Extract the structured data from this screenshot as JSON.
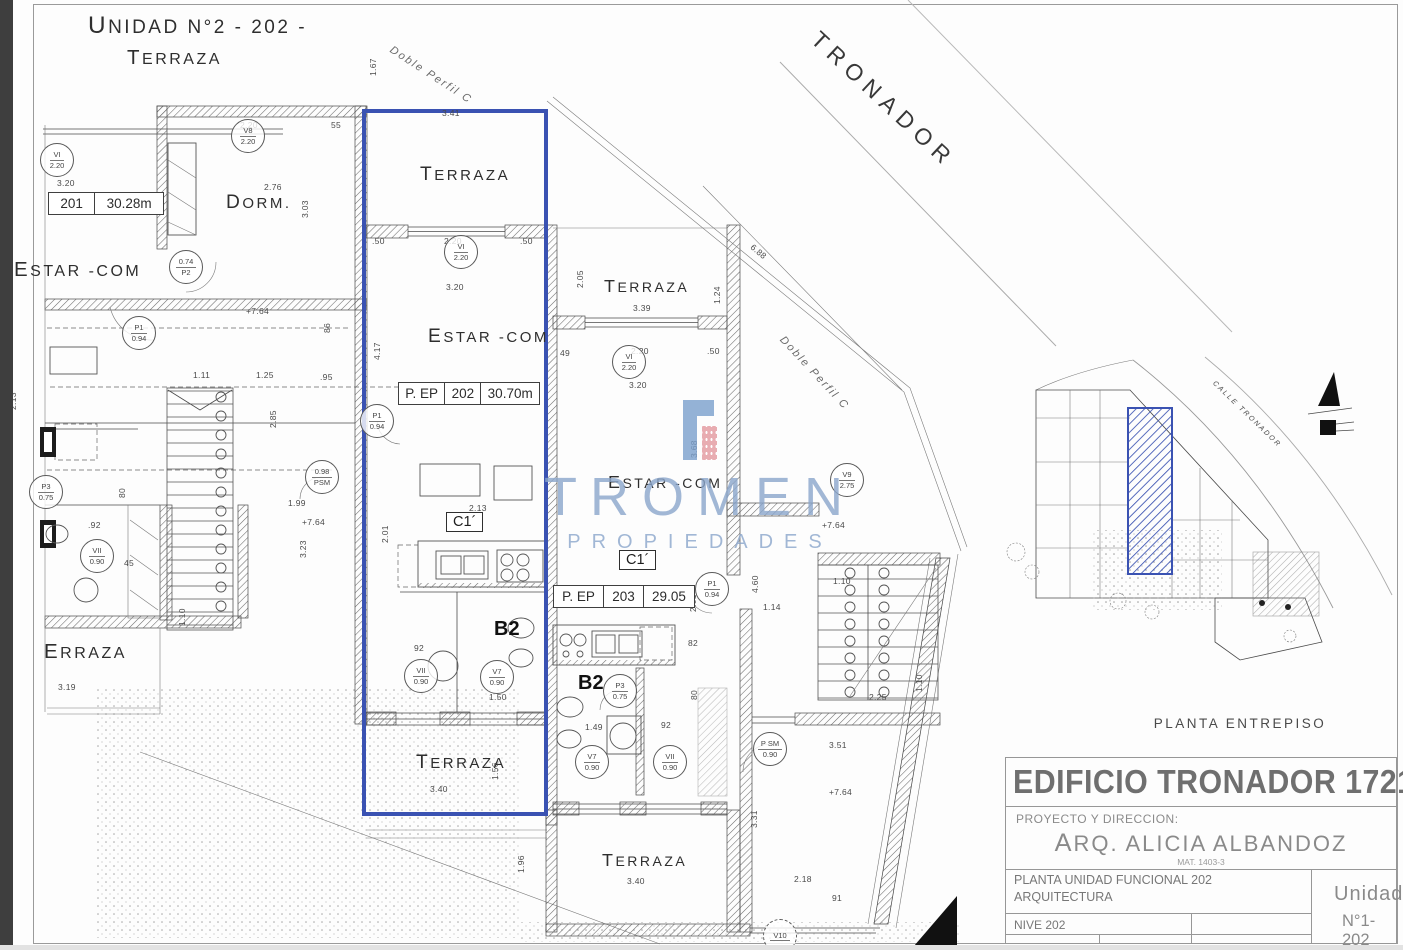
{
  "colors": {
    "highlight_blue": "#3a52b2",
    "watermark_blue": "#8ba6cc",
    "logo_blue": "#7ba0cd",
    "logo_pink": "#e4989f",
    "title_gray": "#6f6f6f",
    "wall_line": "#4a4a4a"
  },
  "plan": {
    "labels": [
      {
        "t": "UNIDAD N°2 - 202 -",
        "x": 88,
        "y": 12,
        "s": 19,
        "cls": "room"
      },
      {
        "t": "TERRAZA",
        "x": 127,
        "y": 46,
        "s": 16,
        "cls": "room"
      },
      {
        "t": "DORM.",
        "x": 226,
        "y": 192,
        "s": 15,
        "cls": "room"
      },
      {
        "t": "ESTAR -COM",
        "x": 14,
        "y": 258,
        "s": 16,
        "cls": "room"
      },
      {
        "t": "ERRAZA",
        "x": 44,
        "y": 640,
        "s": 16,
        "cls": "room"
      },
      {
        "t": "TERRAZA",
        "x": 420,
        "y": 164,
        "s": 15,
        "cls": "room"
      },
      {
        "t": "ESTAR -COM",
        "x": 428,
        "y": 326,
        "s": 15,
        "cls": "room"
      },
      {
        "t": "TERRAZA",
        "x": 416,
        "y": 752,
        "s": 15,
        "cls": "room"
      },
      {
        "t": "TERRAZA",
        "x": 604,
        "y": 276,
        "s": 14,
        "cls": "room"
      },
      {
        "t": "ESTAR -COM",
        "x": 608,
        "y": 472,
        "s": 14,
        "cls": "room"
      },
      {
        "t": "TERRAZA",
        "x": 602,
        "y": 850,
        "s": 14,
        "cls": "room"
      },
      {
        "t": "B2",
        "x": 494,
        "y": 618,
        "s": 20,
        "cls": "roomb"
      },
      {
        "t": "B2",
        "x": 578,
        "y": 672,
        "s": 20,
        "cls": "roomb"
      },
      {
        "t": "TRONADOR",
        "x": 824,
        "y": 26,
        "s": 23,
        "r": 43,
        "cls": "street"
      },
      {
        "t": "Doble Perfil C",
        "x": 394,
        "y": 44,
        "s": 11,
        "r": 33,
        "cls": "ital"
      },
      {
        "t": "Doble Perfil C",
        "x": 786,
        "y": 334,
        "s": 11,
        "r": 47,
        "cls": "ital"
      },
      {
        "t": "CALLE TRONADOR",
        "x": 1216,
        "y": 380,
        "s": 7,
        "r": 44,
        "cls": "ital"
      },
      {
        "t": "2.20",
        "x": 240,
        "y": 120,
        "cls": "dim"
      },
      {
        "t": "55",
        "x": 331,
        "y": 120,
        "cls": "dim"
      },
      {
        "t": "3.20",
        "x": 57,
        "y": 178,
        "cls": "dim"
      },
      {
        "t": "2.76",
        "x": 264,
        "y": 182,
        "cls": "dim"
      },
      {
        "t": "3.03",
        "x": 300,
        "y": 218,
        "r": -90,
        "cls": "dim"
      },
      {
        "t": "1.67",
        "x": 368,
        "y": 76,
        "r": -90,
        "cls": "dim"
      },
      {
        "t": "3.41",
        "x": 442,
        "y": 108,
        "cls": "dim"
      },
      {
        "t": ".50",
        "x": 372,
        "y": 236,
        "cls": "dim"
      },
      {
        "t": "2.20",
        "x": 444,
        "y": 236,
        "cls": "dim"
      },
      {
        "t": ".50",
        "x": 520,
        "y": 236,
        "cls": "dim"
      },
      {
        "t": "3.20",
        "x": 446,
        "y": 282,
        "cls": "dim"
      },
      {
        "t": "4.17",
        "x": 372,
        "y": 360,
        "r": -90,
        "cls": "dim"
      },
      {
        "t": "+7.64",
        "x": 246,
        "y": 306,
        "cls": "dim"
      },
      {
        "t": "86",
        "x": 322,
        "y": 333,
        "r": -90,
        "cls": "dim"
      },
      {
        "t": "1.11",
        "x": 193,
        "y": 370,
        "cls": "dim"
      },
      {
        "t": "1.25",
        "x": 256,
        "y": 370,
        "cls": "dim"
      },
      {
        "t": ".95",
        "x": 320,
        "y": 372,
        "cls": "dim"
      },
      {
        "t": "2.85",
        "x": 268,
        "y": 428,
        "r": -90,
        "cls": "dim"
      },
      {
        "t": "2.13",
        "x": 8,
        "y": 410,
        "r": -90,
        "cls": "dim"
      },
      {
        "t": "2.01",
        "x": 380,
        "y": 543,
        "r": -90,
        "cls": "dim"
      },
      {
        "t": "3.23",
        "x": 298,
        "y": 558,
        "r": -90,
        "cls": "dim"
      },
      {
        "t": "1.99",
        "x": 288,
        "y": 498,
        "cls": "dim"
      },
      {
        "t": "+7.64",
        "x": 302,
        "y": 517,
        "cls": "dim"
      },
      {
        "t": "1.10",
        "x": 177,
        "y": 626,
        "r": -90,
        "cls": "dim"
      },
      {
        "t": ".92",
        "x": 88,
        "y": 520,
        "cls": "dim"
      },
      {
        "t": "80",
        "x": 117,
        "y": 498,
        "r": -90,
        "cls": "dim"
      },
      {
        "t": "45",
        "x": 124,
        "y": 558,
        "cls": "dim"
      },
      {
        "t": "92",
        "x": 414,
        "y": 643,
        "cls": "dim"
      },
      {
        "t": "1.50",
        "x": 489,
        "y": 692,
        "cls": "dim"
      },
      {
        "t": "2.13",
        "x": 469,
        "y": 503,
        "cls": "dim"
      },
      {
        "t": "3.40",
        "x": 430,
        "y": 784,
        "cls": "dim"
      },
      {
        "t": "1.56",
        "x": 490,
        "y": 780,
        "r": -90,
        "cls": "dim"
      },
      {
        "t": "2.05",
        "x": 575,
        "y": 288,
        "r": -90,
        "cls": "dim"
      },
      {
        "t": "3.39",
        "x": 633,
        "y": 303,
        "cls": "dim"
      },
      {
        "t": "1.24",
        "x": 712,
        "y": 304,
        "r": -90,
        "cls": "dim"
      },
      {
        "t": "49",
        "x": 560,
        "y": 348,
        "cls": "dim"
      },
      {
        "t": "2.20",
        "x": 631,
        "y": 346,
        "cls": "dim"
      },
      {
        "t": ".50",
        "x": 707,
        "y": 346,
        "cls": "dim"
      },
      {
        "t": "3.20",
        "x": 629,
        "y": 380,
        "cls": "dim"
      },
      {
        "t": "3.68",
        "x": 689,
        "y": 458,
        "r": -90,
        "cls": "dim"
      },
      {
        "t": "2.01",
        "x": 688,
        "y": 612,
        "r": -90,
        "cls": "dim"
      },
      {
        "t": "1.49",
        "x": 585,
        "y": 722,
        "cls": "dim"
      },
      {
        "t": "82",
        "x": 688,
        "y": 638,
        "cls": "dim"
      },
      {
        "t": "80",
        "x": 689,
        "y": 700,
        "r": -90,
        "cls": "dim"
      },
      {
        "t": "92",
        "x": 661,
        "y": 720,
        "cls": "dim"
      },
      {
        "t": "6.88",
        "x": 755,
        "y": 242,
        "r": 40,
        "cls": "dim"
      },
      {
        "t": "+7.64",
        "x": 822,
        "y": 520,
        "cls": "dim"
      },
      {
        "t": "4.60",
        "x": 750,
        "y": 593,
        "r": -90,
        "cls": "dim"
      },
      {
        "t": "1.14",
        "x": 763,
        "y": 602,
        "cls": "dim"
      },
      {
        "t": "1.10",
        "x": 833,
        "y": 576,
        "cls": "dim"
      },
      {
        "t": "2.25",
        "x": 869,
        "y": 692,
        "cls": "dim"
      },
      {
        "t": "1.10",
        "x": 914,
        "y": 692,
        "r": -90,
        "cls": "dim"
      },
      {
        "t": "3.51",
        "x": 829,
        "y": 740,
        "cls": "dim"
      },
      {
        "t": "+7.64",
        "x": 829,
        "y": 787,
        "cls": "dim"
      },
      {
        "t": "3.31",
        "x": 749,
        "y": 828,
        "r": -90,
        "cls": "dim"
      },
      {
        "t": "3.40",
        "x": 627,
        "y": 876,
        "cls": "dim"
      },
      {
        "t": "2.18",
        "x": 794,
        "y": 874,
        "cls": "dim"
      },
      {
        "t": "91",
        "x": 832,
        "y": 893,
        "cls": "dim"
      },
      {
        "t": "1.96",
        "x": 516,
        "y": 873,
        "r": -90,
        "cls": "dim"
      },
      {
        "t": "3.19",
        "x": 58,
        "y": 682,
        "cls": "dim"
      }
    ],
    "circle_tags": [
      {
        "top": "VI",
        "bot": "2.20",
        "x": 57,
        "y": 160
      },
      {
        "top": "V8",
        "bot": "2.20",
        "x": 248,
        "y": 136
      },
      {
        "top": "0.74",
        "bot": "P2",
        "x": 186,
        "y": 267
      },
      {
        "top": "P1",
        "bot": "0.94",
        "x": 139,
        "y": 333
      },
      {
        "top": "P1",
        "bot": "0.94",
        "x": 377,
        "y": 421
      },
      {
        "top": "0.98",
        "bot": "PSM",
        "x": 322,
        "y": 477
      },
      {
        "top": "P3",
        "bot": "0.75",
        "x": 46,
        "y": 492
      },
      {
        "top": "VII",
        "bot": "0.90",
        "x": 97,
        "y": 556
      },
      {
        "top": "VI",
        "bot": "2.20",
        "x": 461,
        "y": 252
      },
      {
        "top": "VII",
        "bot": "0.90",
        "x": 421,
        "y": 676
      },
      {
        "top": "V7",
        "bot": "0.90",
        "x": 497,
        "y": 677
      },
      {
        "top": "VI",
        "bot": "2.20",
        "x": 629,
        "y": 362
      },
      {
        "top": "P1",
        "bot": "0.94",
        "x": 712,
        "y": 589
      },
      {
        "top": "V9",
        "bot": "2.75",
        "x": 847,
        "y": 480
      },
      {
        "top": "P3",
        "bot": "0.75",
        "x": 620,
        "y": 691
      },
      {
        "top": "V7",
        "bot": "0.90",
        "x": 592,
        "y": 762
      },
      {
        "top": "VII",
        "bot": "0.90",
        "x": 670,
        "y": 762
      },
      {
        "top": "P SM",
        "bot": "0.90",
        "x": 770,
        "y": 749
      },
      {
        "top": "V10",
        "bot": "",
        "x": 780,
        "y": 936,
        "dash": true
      }
    ],
    "area_boxes": [
      {
        "cells": [
          "201",
          "30.28m"
        ],
        "x": 48,
        "y": 192,
        "w": 116
      },
      {
        "cells": [
          "P. EP",
          "202",
          "30.70m"
        ],
        "x": 398,
        "y": 382,
        "w": 142
      },
      {
        "cells": [
          "P. EP",
          "203",
          "29.05"
        ],
        "x": 553,
        "y": 585,
        "w": 142
      }
    ],
    "kitchen_tags": [
      {
        "t": "C1´",
        "x": 446,
        "y": 512
      },
      {
        "t": "C1´",
        "x": 619,
        "y": 550
      }
    ]
  },
  "watermark": {
    "brand": "TROMEN",
    "subtitle": "PROPIEDADES"
  },
  "minimap": {
    "caption": "PLANTA ENTREPISO",
    "street_label": "CALLE TRONADOR"
  },
  "titleblock": {
    "building": "EDIFICIO TRONADOR 1721",
    "project_label": "PROYECTO Y DIRECCION:",
    "architect": "ARQ. ALICIA ALBANDOZ",
    "mat": "MAT. 1403-3",
    "sheet_line1": "PLANTA UNIDAD FUNCIONAL 202",
    "sheet_line2": "ARQUITECTURA",
    "level": "NIVE 202",
    "unit_label": "Unidad",
    "unit_number": "N°1-202"
  }
}
